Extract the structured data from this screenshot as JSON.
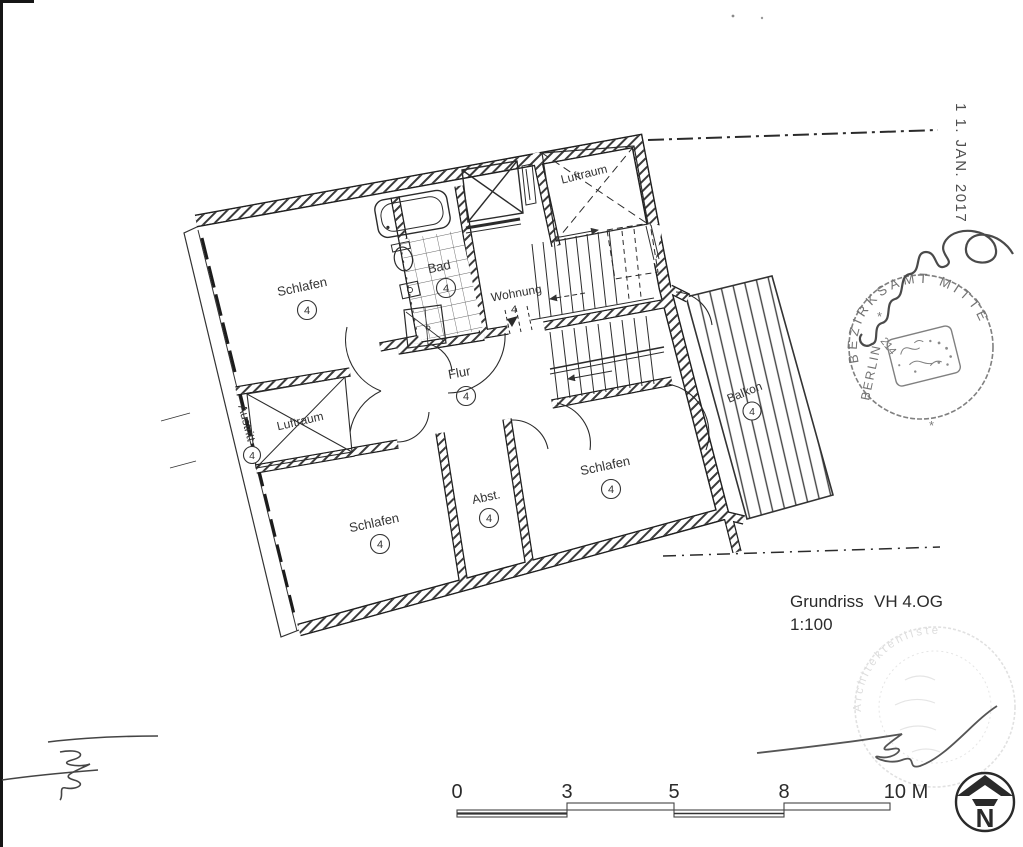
{
  "plan": {
    "labels": {
      "schlafen_tl": {
        "name": "Schlafen",
        "no": "4"
      },
      "bad": {
        "name": "Bad",
        "no": "4"
      },
      "wohnung": {
        "name": "Wohnung",
        "no": "4"
      },
      "luftraum_tr": {
        "name": "Luftraum"
      },
      "flur": {
        "name": "Flur",
        "no": "4"
      },
      "austritt": {
        "name": "Austritt",
        "no": "4"
      },
      "luftraum_bl": {
        "name": "Luftraum"
      },
      "schlafen_bl": {
        "name": "Schlafen",
        "no": "4"
      },
      "abst": {
        "name": "Abst.",
        "no": "4"
      },
      "schlafen_br": {
        "name": "Schlafen",
        "no": "4"
      },
      "balkon": {
        "name": "Balkon",
        "no": "4"
      }
    },
    "caption": {
      "title": "Grundriss",
      "variant": "VH 4.OG",
      "scale": "1:100"
    }
  },
  "scale_bar": {
    "ticks": [
      "0",
      "3",
      "5",
      "8"
    ],
    "end_label": "10 M"
  },
  "north": {
    "label": "N"
  },
  "stamps": {
    "date": "1 1. JAN. 2017",
    "bezirksamt": {
      "arc": "BEZIRKSAMT MITTE",
      "side": "BERLIN",
      "number": "214",
      "separator": "*"
    },
    "architect": {
      "arc": "Architektenliste"
    }
  },
  "colors": {
    "ink": "#2b2b2b",
    "wall": "#333333",
    "stamp": "#5a5a5a",
    "faint_stamp": "#9a9a9a"
  }
}
